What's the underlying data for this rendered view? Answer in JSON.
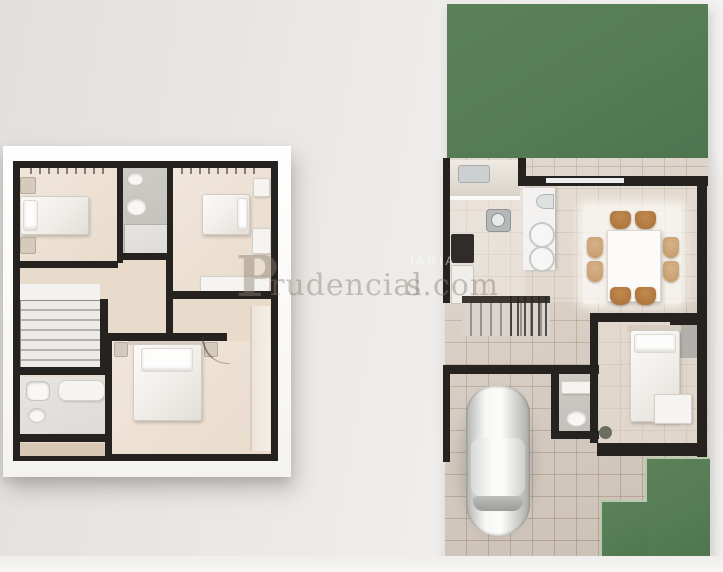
{
  "watermark": {
    "monogram": "P",
    "name": "rudencial",
    "suffix": "s.com",
    "small": "IARIA"
  },
  "palette": {
    "grass_green": "#567c55",
    "wall_black": "#26221f",
    "floor_beige": "#efe4d9",
    "bathroom_gray": "#c9c5c1",
    "patio_tile": "#d6cabe",
    "chair_tan": "#b17c42",
    "chair_light_tan": "#cfa878",
    "background_wall": "#eae8e5",
    "board_white": "#fbfbfa",
    "car_white": "#f4f4f2"
  }
}
